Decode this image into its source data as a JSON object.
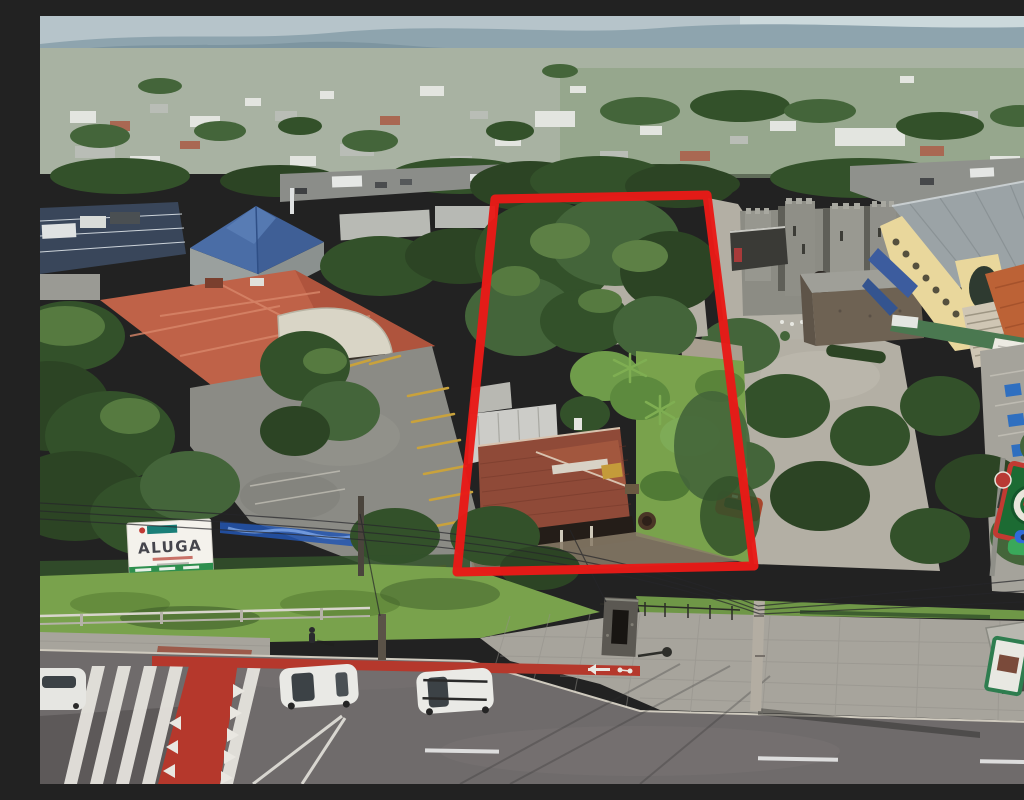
{
  "photo": {
    "kind": "aerial-drone-photo",
    "description": "Oblique aerial view of a suburban commercial block; a trapezoidal corner lot with an old red-tile-roof house, gravel yard and dense trees is outlined in thick red; surrounded by a restaurant with salmon tile roof, a stone castle-style building, a yellow restaurant complex, parking lots, and a street with crosswalk and red bike lane in front."
  },
  "parcel": {
    "outline_points": "455,183 667,179 714,550 417,556",
    "outline_color": "#e81a17",
    "outline_width": "9"
  },
  "signs": {
    "aluga": {
      "title": "ALUGA",
      "board_color": "#f4f2ec",
      "strip_color": "#2e8f4e",
      "logo_color": "#1a7f78"
    },
    "restaurant_sign": {
      "panel_color": "#1c6b33",
      "border_color": "#c23a32"
    },
    "bus_shelter_ad_frame_color": "#2e7d4f",
    "round_sign_color": "#b83a34"
  },
  "road": {
    "asphalt_color": "#6f6b6b",
    "bike_lane_color": "#b5382c",
    "marking_color": "#e9e7e1"
  },
  "palette": {
    "sky": "#b6c4ca",
    "hills": "#8ea4ae",
    "canopy": "#33512a",
    "grass": "#79a24c",
    "gravel": "#b3afa4",
    "left_restaurant_roof": "#bf6248",
    "house_roof": "#8f4a38",
    "yellow_building_wall": "#e9d79c",
    "metal_roof": "#9ba3a6",
    "castle_stone": "#8c8c84",
    "blue_pyramid_roof": "#4a6da6",
    "cobblestone": "#a7a49c"
  }
}
